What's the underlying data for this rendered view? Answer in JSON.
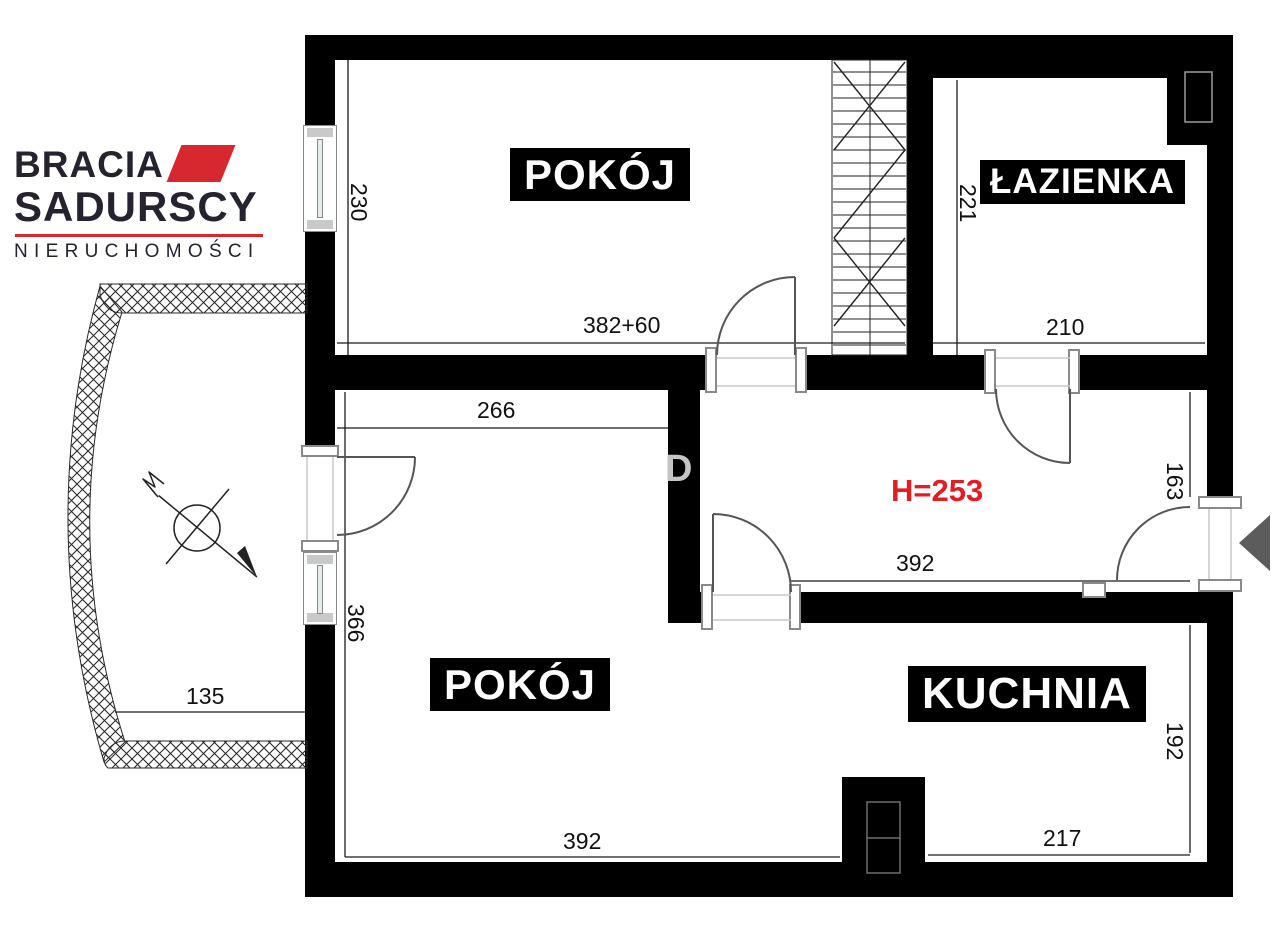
{
  "logo": {
    "brand_top": "BRACIA",
    "brand_bottom": "SADURSCY",
    "tagline": "NIERUCHOMOŚCI"
  },
  "rooms": {
    "pokoj_top": "POKÓJ",
    "lazienka": "ŁAZIENKA",
    "pokoj_bottom": "POKÓJ",
    "kuchnia": "KUCHNIA"
  },
  "dims": {
    "pokoj_top_h": "230",
    "pokoj_top_w": "382+60",
    "lazienka_h": "221",
    "lazienka_w": "210",
    "pokoj_bottom_top_w": "266",
    "pokoj_bottom_h": "366",
    "balkon_w": "135",
    "hall_kitchen_w": "392",
    "entry_wall_h": "163",
    "pokoj_bottom_w": "392",
    "kuchnia_w": "217",
    "kuchnia_h": "192"
  },
  "annotations": {
    "height_note": "H=253",
    "wall_letter": "D"
  },
  "colors": {
    "wall": "#000000",
    "dim_text": "#111111",
    "height_note": "#e21d24",
    "logo_dark": "#262230",
    "logo_red": "#d7282f",
    "door_stroke": "#555555"
  }
}
